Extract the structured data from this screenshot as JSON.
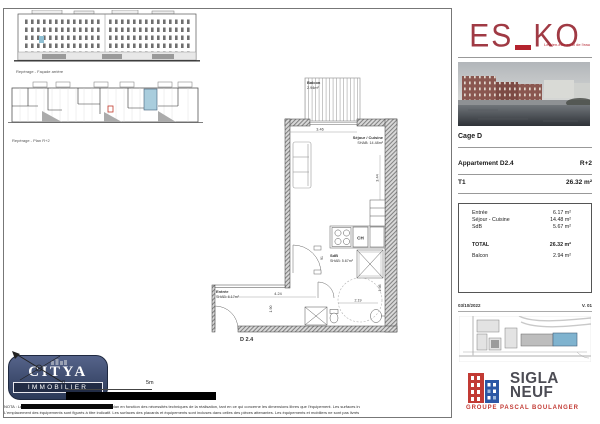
{
  "reperage": {
    "facade_caption": "Repérage - Façade arrière",
    "plan_caption": "Repérage - Plan R+2"
  },
  "plan": {
    "balcon": {
      "name": "Balcon",
      "area": "2.94m²"
    },
    "sejour": {
      "name": "Séjour / Cuisine",
      "area": "SHAB: 14.48m²"
    },
    "sdb": {
      "name": "SdB",
      "area": "SHAB: 5.67m²"
    },
    "entree": {
      "name": "Entrée",
      "area": "SHAB: 6.17m²"
    },
    "ch": "CH",
    "unit": "D 2.4",
    "dims": {
      "sejour_w": "3.46",
      "sejour_h": "3.44",
      "entree_w": "4.24",
      "entree_h": "1.90",
      "sdb_w": "2.19",
      "bath_h": "1.98",
      "door_w": "91"
    }
  },
  "brand": {
    "logo_left": "ES",
    "logo_right": "KO",
    "tagline": "Le bien-être au fil de l'eau"
  },
  "info": {
    "cage": "Cage D",
    "apartment": "Appartement D2.4",
    "floor": "R+2",
    "type": "T1",
    "area": "26.32 m²"
  },
  "areas": {
    "rows": [
      {
        "label": "Entrée",
        "value": "6.17 m²"
      },
      {
        "label": "Séjour - Cuisine",
        "value": "14.48 m²"
      },
      {
        "label": "SdB",
        "value": "5.67 m²"
      }
    ],
    "total": {
      "label": "TOTAL",
      "value": "26.32 m²"
    },
    "balcon": {
      "label": "Balcon",
      "value": "2.94 m²"
    }
  },
  "meta": {
    "date": "03/10/2022",
    "version": "V. 01"
  },
  "scalebar": {
    "zero": "0",
    "max": "5m"
  },
  "citya": {
    "name": "CITYA",
    "sub": "IMMOBILIER"
  },
  "sigla": {
    "line1": "SIGLA",
    "line2": "NEUF",
    "group": "GROUPE PASCAL BOULANGER"
  },
  "nota": {
    "line1": "NOTA : Les modifications susceptibles d'être apportées à ce plan en fonction des nécessités techniques de la réalisation, tant en ce qui concerne les dimensions libres que l'équipement. Les surfaces indiquées sont",
    "line2": "L'emplacement des équipements sont figurés à titre indicatif. Les surfaces des placards et équipements sont incluses dans celles des pièces attenantes. Les équipements et mobiliers ne sont pas livrés avec le logement."
  },
  "colors": {
    "brand_red": "#a03a44",
    "highlight_blue": "#9fc6d8",
    "citya_navy": "#35425f",
    "sigla_red": "#c23a34",
    "sigla_blue": "#2b57a5"
  }
}
